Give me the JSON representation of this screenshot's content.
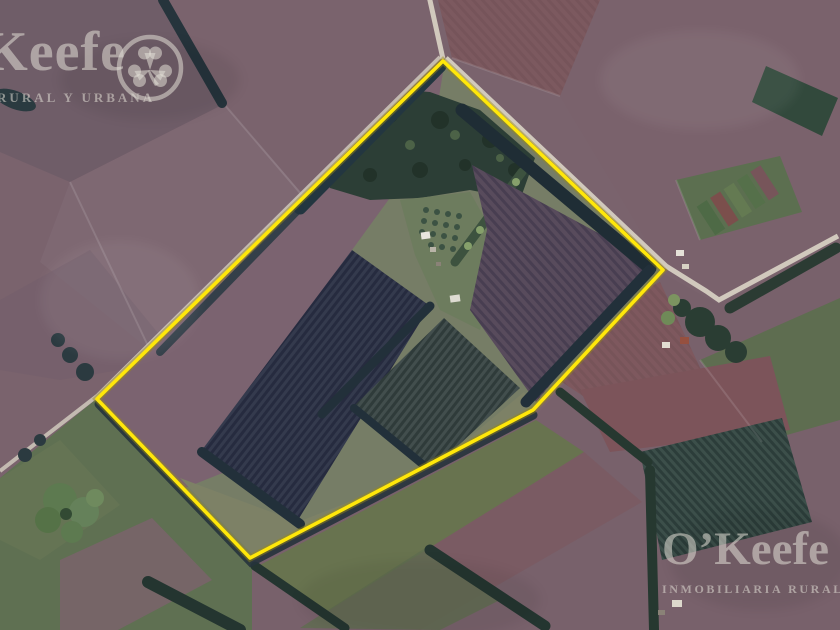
{
  "watermarks": {
    "top_left": {
      "brand": "O’Keefe",
      "subtitle": "INMOBILIARIA RURAL Y URBANA"
    },
    "bottom_right": {
      "brand": "O’Keefe",
      "subtitle": "INMOBILIARIA RURAL Y URBANA"
    }
  },
  "map": {
    "description": "aerial satellite photo of rural farmland with outlined parcel",
    "boundary_color": "#ffe70a",
    "boundary_glow": "#9c8c14",
    "road_color": "#d6cfc2",
    "watermark_color": "rgba(226,222,213,0.55)",
    "field_palette": {
      "mauve": "#7a636d",
      "brown": "#6f5d68",
      "red_brown": "#7c5a60",
      "green": "#5f7052",
      "pasture": "#7d8268",
      "woods": "#2c3e36",
      "row_crop_dark": "#31364a",
      "row_crop_green": "#3e4a4a",
      "row_crop_purple": "#54475a"
    }
  }
}
